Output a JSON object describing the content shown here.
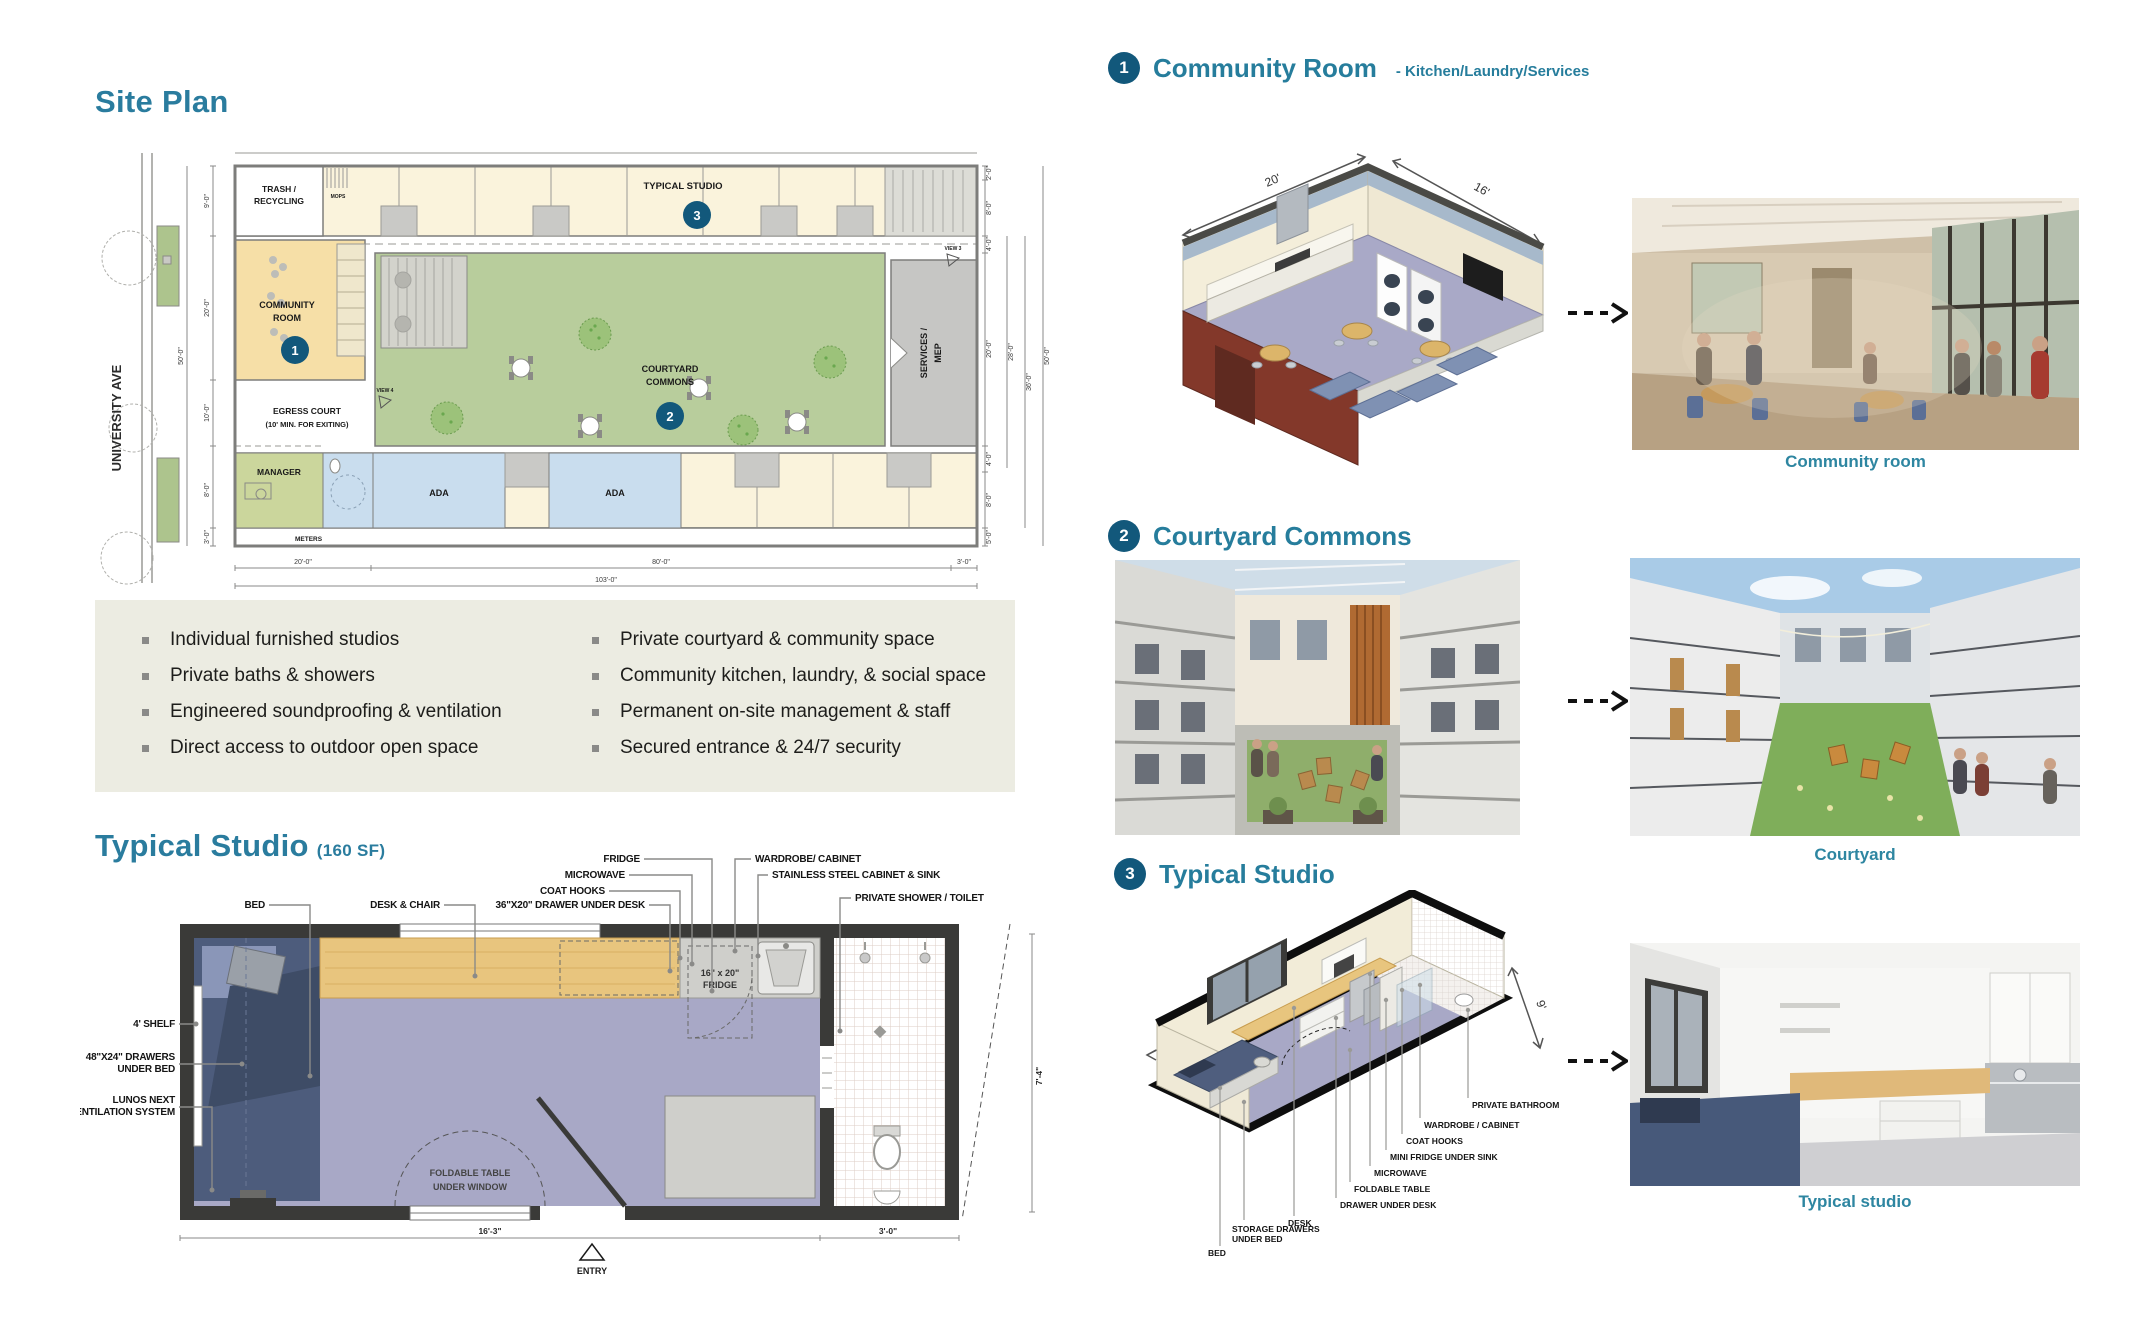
{
  "site_plan": {
    "title": "Site Plan",
    "street": "UNIVERSITY AVE",
    "rooms": {
      "trash_line1": "TRASH /",
      "trash_line2": "RECYCLING",
      "mops": "MOPS",
      "typical_studio": "TYPICAL STUDIO",
      "community_line1": "COMMUNITY",
      "community_line2": "ROOM",
      "courtyard_line1": "COURTYARD",
      "courtyard_line2": "COMMONS",
      "egress_line1": "EGRESS COURT",
      "egress_line2": "(10' MIN. FOR EXITING)",
      "services_line1": "SERVICES /",
      "services_line2": "MEP",
      "manager": "MANAGER",
      "ada_left": "ADA",
      "ada_right": "ADA",
      "meters": "METERS",
      "view3": "VIEW 3",
      "view4": "VIEW 4"
    },
    "badges": {
      "one": "1",
      "two": "2",
      "three": "3"
    },
    "dims_left": [
      "9'-0\"",
      "20'-0\"",
      "10'-0\"",
      "8'-0\"",
      "3'-0\"",
      "50'-0\""
    ],
    "dims_bottom": [
      "20'-0\"",
      "80'-0\"",
      "3'-0\"",
      "103'-0\""
    ],
    "dims_right": [
      "2'-0\"",
      "8'-0\"",
      "4'-0\"",
      "20'-0\"",
      "4'-0\"",
      "8'-0\"",
      "5'-0\"",
      "28'-0\"",
      "36'-0\"",
      "50'-0\""
    ]
  },
  "features": {
    "left": [
      "Individual furnished studios",
      "Private baths & showers",
      "Engineered soundproofing & ventilation",
      "Direct access to outdoor open space"
    ],
    "right": [
      "Private courtyard & community space",
      "Community kitchen, laundry, & social space",
      "Permanent on-site management & staff",
      "Secured entrance & 24/7 security"
    ]
  },
  "studio_plan": {
    "title": "Typical Studio",
    "area": "(160 SF)",
    "labels": {
      "bed": "BED",
      "desk_chair": "DESK & CHAIR",
      "drawer_under_desk": "36\"X20\" DRAWER UNDER DESK",
      "coat_hooks": "COAT HOOKS",
      "microwave": "MICROWAVE",
      "fridge": "FRIDGE",
      "wardrobe": "WARDROBE/ CABINET",
      "stainless": "STAINLESS STEEL CABINET & SINK",
      "shower": "PRIVATE SHOWER / TOILET",
      "shelf": "4' SHELF",
      "drawers_line1": "48\"X24\" DRAWERS",
      "drawers_line2": "UNDER BED",
      "lunos_line1": "LUNOS NEXT",
      "lunos_line2": "VENTILATION SYSTEM",
      "fridge_in_line1": "16\" x 20\"",
      "fridge_in_line2": "FRIDGE",
      "table_line1": "FOLDABLE TABLE",
      "table_line2": "UNDER WINDOW",
      "entry": "ENTRY"
    },
    "dims": {
      "width": "16'-3\"",
      "bath": "3'-0\"",
      "depth": "7'-4\""
    }
  },
  "sections": {
    "one": {
      "num": "1",
      "title": "Community Room",
      "subtitle": "- Kitchen/Laundry/Services",
      "caption": "Community room",
      "dim_w": "20'",
      "dim_d": "16'"
    },
    "two": {
      "num": "2",
      "title": "Courtyard Commons",
      "caption": "Courtyard"
    },
    "three": {
      "num": "3",
      "title": "Typical Studio",
      "caption": "Typical studio",
      "dim_w": "20'",
      "dim_d": "8'",
      "dim_h": "9'",
      "labels": [
        "BED",
        "STORAGE DRAWERS",
        "UNDER BED",
        "DESK",
        "DRAWER UNDER DESK",
        "FOLDABLE TABLE",
        "MICROWAVE",
        "MINI FRIDGE UNDER SINK",
        "COAT HOOKS",
        "WARDROBE / CABINET",
        "PRIVATE BATHROOM"
      ]
    }
  }
}
